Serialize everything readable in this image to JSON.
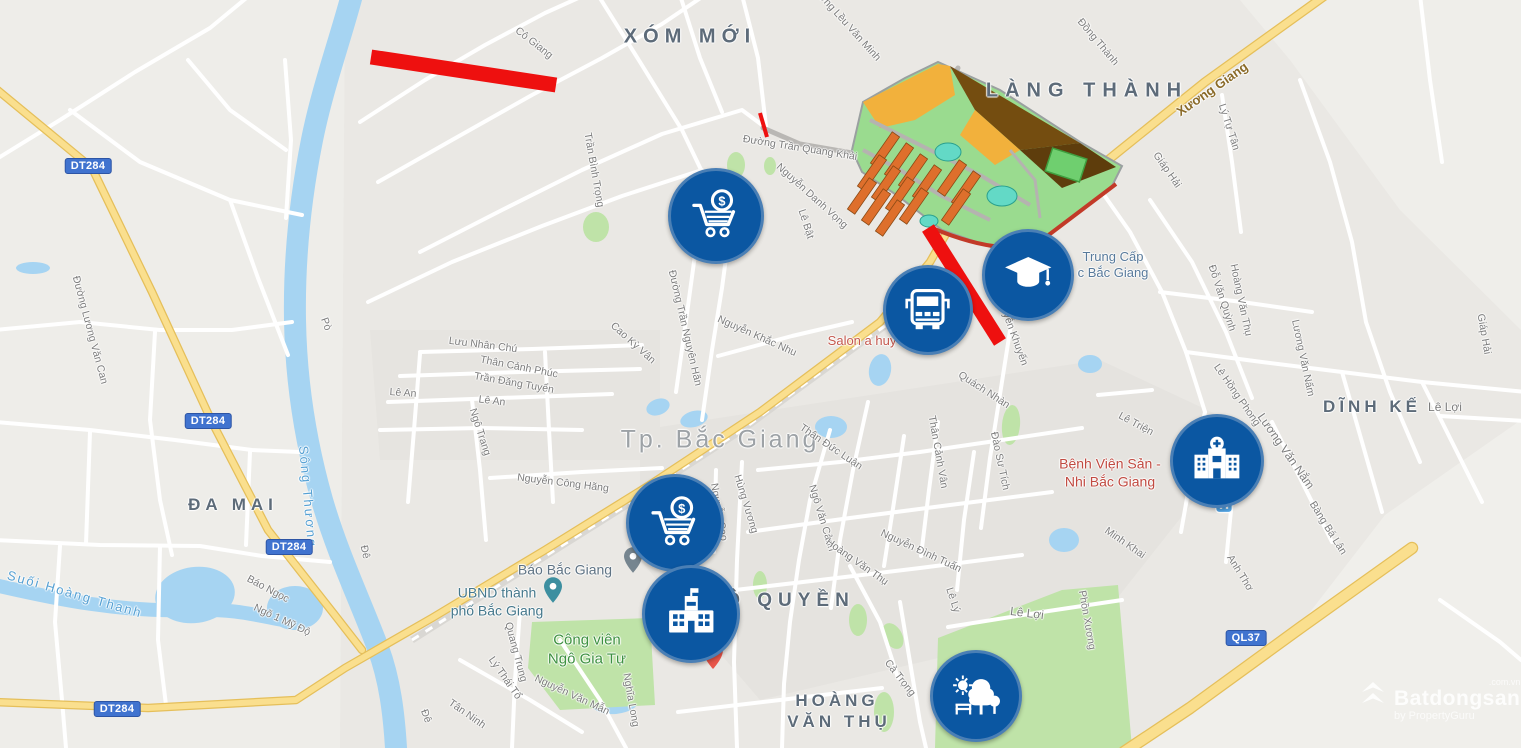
{
  "meta": {
    "width": 1521,
    "height": 748
  },
  "watermark": {
    "brand": "Batdongsan",
    "suffix": ".com.vn",
    "byline": "by PropertyGuru"
  },
  "shields": [
    {
      "t": "DT284",
      "x": 88,
      "y": 166
    },
    {
      "t": "DT284",
      "x": 208,
      "y": 421
    },
    {
      "t": "DT284",
      "x": 289,
      "y": 547
    },
    {
      "t": "DT284",
      "x": 117,
      "y": 709
    },
    {
      "t": "QL37",
      "x": 1246,
      "y": 638
    }
  ],
  "area_labels": [
    {
      "t": "XÓM MỚI",
      "x": 690,
      "y": 37,
      "fs": 20,
      "ls": 6
    },
    {
      "t": "LÀNG THÀNH",
      "x": 1087,
      "y": 91,
      "fs": 20,
      "ls": 7
    },
    {
      "t": "ĐA MAI",
      "x": 233,
      "y": 505,
      "fs": 17,
      "ls": 5
    },
    {
      "t": "DĨNH KẾ",
      "x": 1372,
      "y": 407,
      "fs": 17,
      "ls": 4
    },
    {
      "t": "Ô QUYỀN",
      "x": 790,
      "y": 601,
      "fs": 19,
      "ls": 6
    },
    {
      "t": "HOÀNG",
      "x": 837,
      "y": 701,
      "fs": 17,
      "ls": 4
    },
    {
      "t": "VĂN THỤ",
      "x": 839,
      "y": 722,
      "fs": 17,
      "ls": 4
    }
  ],
  "city_label": {
    "t": "Tp. Bắc Giang",
    "x": 720,
    "y": 440,
    "fs": 25,
    "ls": 3
  },
  "street_labels": [
    {
      "t": "Cô Giang",
      "x": 534,
      "y": 43,
      "r": 38
    },
    {
      "t": "Đường Lều Văn Minh",
      "x": 845,
      "y": 22,
      "r": 48
    },
    {
      "t": "Đồng Thành",
      "x": 1098,
      "y": 42,
      "r": 50
    },
    {
      "t": "Lý Tự Tân",
      "x": 1229,
      "y": 127,
      "r": 72
    },
    {
      "t": "Giáp Hải",
      "x": 1167,
      "y": 170,
      "r": 55
    },
    {
      "t": "Giáp Hải",
      "x": 1484,
      "y": 334,
      "r": 80
    },
    {
      "t": "Trần Bình Trọng",
      "x": 594,
      "y": 170,
      "r": 80
    },
    {
      "t": "Đường Trần Quang Khải",
      "x": 800,
      "y": 148,
      "r": 9
    },
    {
      "t": "Nguyễn Danh Vọng",
      "x": 812,
      "y": 196,
      "r": 42
    },
    {
      "t": "Lê Bật",
      "x": 806,
      "y": 224,
      "r": 72
    },
    {
      "t": "Đường Lương Văn Can",
      "x": 90,
      "y": 330,
      "r": 75
    },
    {
      "t": "Pò",
      "x": 326,
      "y": 324,
      "r": 70
    },
    {
      "t": "Đê",
      "x": 365,
      "y": 552,
      "r": 78
    },
    {
      "t": "Đê",
      "x": 426,
      "y": 716,
      "r": 70
    },
    {
      "t": "Báo Ngọc",
      "x": 268,
      "y": 589,
      "r": 28
    },
    {
      "t": "Ngõ 1 Mỹ Độ",
      "x": 282,
      "y": 620,
      "r": 25
    },
    {
      "t": "Lưu Nhân Chú",
      "x": 483,
      "y": 345,
      "r": 7
    },
    {
      "t": "Thân Cảnh Phúc",
      "x": 519,
      "y": 367,
      "r": 11
    },
    {
      "t": "Trần Đăng Tuyển",
      "x": 514,
      "y": 383,
      "r": 10
    },
    {
      "t": "Lê An",
      "x": 403,
      "y": 393,
      "r": 4
    },
    {
      "t": "Lê An",
      "x": 492,
      "y": 401,
      "r": 7
    },
    {
      "t": "Ngô Trang",
      "x": 480,
      "y": 432,
      "r": 72
    },
    {
      "t": "Cao Kỳ Vân",
      "x": 633,
      "y": 343,
      "r": 42
    },
    {
      "t": "Đường Trần Nguyên Hãn",
      "x": 685,
      "y": 328,
      "r": 77
    },
    {
      "t": "Nguyễn Khắc Nhu",
      "x": 757,
      "y": 336,
      "r": 24
    },
    {
      "t": "Nguyễn Khuyến",
      "x": 1012,
      "y": 330,
      "r": 70
    },
    {
      "t": "Quách Nhàn",
      "x": 984,
      "y": 390,
      "r": 33
    },
    {
      "t": "Đào Sư Tích",
      "x": 1000,
      "y": 461,
      "r": 78
    },
    {
      "t": "Thân Đức Luận",
      "x": 831,
      "y": 447,
      "r": 34
    },
    {
      "t": "Thân Cảnh Vân",
      "x": 938,
      "y": 452,
      "r": 80
    },
    {
      "t": "Hùng Vương",
      "x": 746,
      "y": 504,
      "r": 73
    },
    {
      "t": "Nguyễn Cao",
      "x": 719,
      "y": 512,
      "r": 80
    },
    {
      "t": "Nguyễn Công Hãng",
      "x": 563,
      "y": 483,
      "r": 7
    },
    {
      "t": "Ngô Văn Cảnh",
      "x": 822,
      "y": 518,
      "r": 73
    },
    {
      "t": "Hoàng Văn Thụ",
      "x": 857,
      "y": 562,
      "r": 35
    },
    {
      "t": "Nguyễn Đình Tuấn",
      "x": 921,
      "y": 551,
      "r": 25
    },
    {
      "t": "Lê Triện",
      "x": 1136,
      "y": 424,
      "r": 28
    },
    {
      "t": "Lê Hồng Phong",
      "x": 1237,
      "y": 395,
      "r": 55
    },
    {
      "t": "Đỗ Văn Quỳnh",
      "x": 1222,
      "y": 298,
      "r": 72
    },
    {
      "t": "Hoàng Văn Thụ",
      "x": 1241,
      "y": 300,
      "r": 78
    },
    {
      "t": "Lương Văn Nấm",
      "x": 1303,
      "y": 358,
      "r": 78
    },
    {
      "t": "Lương Văn Nắm",
      "x": 1286,
      "y": 451,
      "r": 55,
      "fs": 12
    },
    {
      "t": "Minh Khai",
      "x": 1125,
      "y": 543,
      "r": 35
    },
    {
      "t": "Bàng Bá Lân",
      "x": 1328,
      "y": 528,
      "r": 58
    },
    {
      "t": "Anh Thơ",
      "x": 1240,
      "y": 573,
      "r": 58
    },
    {
      "t": "Lê Lợi",
      "x": 1445,
      "y": 407,
      "r": 0,
      "fs": 12
    },
    {
      "t": "Lê Lợi",
      "x": 1027,
      "y": 613,
      "r": 7,
      "fs": 12
    },
    {
      "t": "Lê Lý",
      "x": 953,
      "y": 600,
      "r": 72
    },
    {
      "t": "Phồn Xương",
      "x": 1087,
      "y": 620,
      "r": 80
    },
    {
      "t": "Cả Trọng",
      "x": 900,
      "y": 678,
      "r": 52
    },
    {
      "t": "Quang Trung",
      "x": 516,
      "y": 652,
      "r": 75
    },
    {
      "t": "Lý Thái Tổ",
      "x": 505,
      "y": 678,
      "r": 55
    },
    {
      "t": "Tân Ninh",
      "x": 467,
      "y": 714,
      "r": 35
    },
    {
      "t": "Nguyễn Văn Mẫn",
      "x": 572,
      "y": 695,
      "r": 25
    },
    {
      "t": "Nghĩa Long",
      "x": 631,
      "y": 700,
      "r": 80
    }
  ],
  "road_name_labels": [
    {
      "t": "Xương Giang",
      "x": 1212,
      "y": 89,
      "r": -35
    }
  ],
  "water_labels": [
    {
      "t": "Sông Thương",
      "x": 308,
      "y": 497,
      "r": 85
    },
    {
      "t": "Suối Hoàng Thanh",
      "x": 75,
      "y": 594,
      "r": 16
    }
  ],
  "poi_labels": [
    {
      "lines": [
        "Trung Cấp",
        "c Bắc Giang"
      ],
      "x": 1113,
      "y": 265,
      "color": "#587a9b",
      "fs": 13
    },
    {
      "lines": [
        "Bệnh Viện Sản -",
        "Nhi Bắc Giang"
      ],
      "x": 1110,
      "y": 473,
      "color": "#c14a41",
      "fs": 14
    },
    {
      "lines": [
        "Salon a huy"
      ],
      "x": 862,
      "y": 341,
      "color": "#c4584e",
      "fs": 13
    },
    {
      "lines": [
        "Báo Bắc Giang"
      ],
      "x": 565,
      "y": 570,
      "color": "#5f7384",
      "fs": 14
    },
    {
      "lines": [
        "UBND thành",
        "phố Bắc Giang"
      ],
      "x": 497,
      "y": 602,
      "color": "#45788c",
      "fs": 14
    },
    {
      "lines": [
        "Công viên",
        "Ngô Gia Tự"
      ],
      "x": 587,
      "y": 650,
      "color": "#3d9140",
      "fs": 15
    }
  ],
  "markers": [
    {
      "icon": "cart",
      "x": 713,
      "y": 213,
      "d": 90
    },
    {
      "icon": "bus",
      "x": 925,
      "y": 307,
      "d": 84
    },
    {
      "icon": "graduation",
      "x": 1025,
      "y": 272,
      "d": 86
    },
    {
      "icon": "cart",
      "x": 672,
      "y": 520,
      "d": 92
    },
    {
      "icon": "school",
      "x": 688,
      "y": 611,
      "d": 92
    },
    {
      "icon": "hospital",
      "x": 1214,
      "y": 458,
      "d": 88
    },
    {
      "icon": "park",
      "x": 973,
      "y": 693,
      "d": 86
    }
  ],
  "pins": [
    {
      "type": "poi-gray",
      "x": 633,
      "y": 578
    },
    {
      "type": "poi-teal",
      "x": 553,
      "y": 608
    },
    {
      "type": "hospital-red",
      "x": 713,
      "y": 674
    },
    {
      "type": "transit",
      "x": 1224,
      "y": 524
    }
  ],
  "red_segments": [
    {
      "x1": 371,
      "y1": 57,
      "x2": 556,
      "y2": 85,
      "w": 15
    },
    {
      "x1": 928,
      "y1": 228,
      "x2": 1000,
      "y2": 342,
      "w": 14
    },
    {
      "x1": 760,
      "y1": 113,
      "x2": 767,
      "y2": 137,
      "w": 4
    }
  ],
  "geometry": {
    "tints": [
      {
        "d": "M0,0 L345,0 L340,748 L0,748 Z",
        "f": "#eeede9"
      },
      {
        "d": "M1385,515 L1521,420 L1521,748 L1140,748 L1300,625 Z",
        "f": "#f0efeb"
      },
      {
        "d": "M1240,0 L1521,0 L1521,330 L1400,210 L1290,60 Z",
        "f": "#efeeea"
      },
      {
        "d": "M640,430 L1100,360 L1250,430 L1100,620 L760,700 L640,560 Z",
        "f": "#e5e3df"
      },
      {
        "d": "M370,330 L660,330 L660,460 L380,460 Z",
        "f": "#e6e4e0"
      }
    ],
    "water_paths": [
      {
        "d": "M352,-5 C340,40 322,90 312,140 C300,200 294,260 295,320 C296,380 305,440 322,500 C338,555 360,600 378,648 C390,680 394,715 396,748",
        "w": 22
      },
      {
        "d": "M-5,585 C60,600 120,612 190,610 C240,608 265,618 295,622",
        "w": 14
      }
    ],
    "ponds": [
      {
        "x": 33,
        "y": 268,
        "rx": 17,
        "ry": 6,
        "r": 0
      },
      {
        "x": 658,
        "y": 407,
        "rx": 12,
        "ry": 8,
        "r": -20
      },
      {
        "x": 694,
        "y": 419,
        "rx": 14,
        "ry": 8,
        "r": -15
      },
      {
        "x": 831,
        "y": 427,
        "rx": 16,
        "ry": 11,
        "r": 0
      },
      {
        "x": 880,
        "y": 370,
        "rx": 11,
        "ry": 16,
        "r": 10
      },
      {
        "x": 1090,
        "y": 364,
        "rx": 12,
        "ry": 9,
        "r": 0
      },
      {
        "x": 1064,
        "y": 540,
        "rx": 15,
        "ry": 12,
        "r": 0
      },
      {
        "x": 195,
        "y": 595,
        "rx": 40,
        "ry": 28,
        "r": -8
      },
      {
        "x": 295,
        "y": 608,
        "rx": 28,
        "ry": 22,
        "r": 0
      },
      {
        "x": 585,
        "y": 680,
        "rx": 35,
        "ry": 18,
        "r": -10
      },
      {
        "x": 615,
        "y": 700,
        "rx": 25,
        "ry": 14,
        "r": -5
      },
      {
        "x": 1055,
        "y": 700,
        "rx": 52,
        "ry": 42,
        "r": 0
      }
    ],
    "greens": [
      {
        "type": "poly",
        "d": "M532,622 L650,618 L655,705 L560,710 L528,668 Z"
      },
      {
        "type": "poly",
        "d": "M938,638 L1062,590 L1118,585 L1132,748 L935,748 Z"
      },
      {
        "type": "ell",
        "x": 596,
        "y": 227,
        "rx": 13,
        "ry": 15,
        "r": 0
      },
      {
        "type": "ell",
        "x": 736,
        "y": 165,
        "rx": 9,
        "ry": 13,
        "r": 0
      },
      {
        "type": "ell",
        "x": 770,
        "y": 166,
        "rx": 6,
        "ry": 9,
        "r": 0
      },
      {
        "type": "ell",
        "x": 1011,
        "y": 425,
        "rx": 9,
        "ry": 20,
        "r": 5
      },
      {
        "type": "ell",
        "x": 858,
        "y": 620,
        "rx": 9,
        "ry": 16,
        "r": 0
      },
      {
        "type": "ell",
        "x": 884,
        "y": 712,
        "rx": 10,
        "ry": 20,
        "r": 0
      },
      {
        "type": "ell",
        "x": 760,
        "y": 585,
        "rx": 7,
        "ry": 14,
        "r": 0
      },
      {
        "type": "ell",
        "x": 893,
        "y": 636,
        "rx": 9,
        "ry": 14,
        "r": -30
      }
    ],
    "railway": {
      "d": "M412,640 L520,572 L622,508 L742,430 L862,342 L905,312"
    },
    "roads_white": [
      "M-5,160 L60,120 L135,72 L210,28 L250,-5",
      "M70,110 L140,162 L230,200 L302,215",
      "M230,200 L258,278 L288,355",
      "M-5,330 L80,322 L160,330 L232,330 L292,322",
      "M155,332 L150,420 L160,500 L172,555",
      "M-5,422 L90,430 L175,440 L252,450 L300,452",
      "M-5,540 L100,545 L200,546 L262,556 L330,562",
      "M60,546 L55,622 L62,700 L66,748",
      "M160,546 L158,640 L166,705",
      "M250,452 L246,545",
      "M90,432 L86,544",
      "M285,60 L291,140 L286,218",
      "M188,60 L230,110 L286,150",
      "M360,122 L425,80 L485,45 L545,13 L585,-5",
      "M378,182 L452,140 L532,95 L602,58 L662,24 L705,-5",
      "M598,-5 L640,62 L682,130 L705,178",
      "M420,252 L502,210 L582,170 L662,134 L742,110 L766,128",
      "M368,302 L452,262 L542,226 L622,196 L702,170",
      "M680,-5 L700,58 L722,112",
      "M742,-5 L758,58 L766,126",
      "M420,352 L532,349 L642,345",
      "M400,376 L520,372 L640,369",
      "M388,402 L500,398 L612,394",
      "M380,430 L482,428 L582,430",
      "M472,400 L480,470 L486,540",
      "M420,354 L414,430 L408,502",
      "M545,352 L549,430 L553,502",
      "M676,392 L685,328 L694,262 L703,196",
      "M702,420 L712,350 L722,288 L730,228",
      "M718,356 L792,336 L852,322",
      "M490,478 L582,472 L662,468",
      "M742,462 L737,560 L734,662 L737,748",
      "M716,470 L714,552",
      "M830,430 L810,500 L799,560 L790,622 L784,684 L782,748",
      "M868,402 L853,470 L840,540 L831,608",
      "M904,436 L894,502 L884,566",
      "M938,422 L929,490 L921,556",
      "M974,452 L964,520 L957,590",
      "M1012,318 L1001,388 L990,458 L981,528",
      "M758,470 L840,462 L920,452 L1002,440 L1082,428",
      "M748,532 L850,518 L950,505 L1052,492",
      "M718,592 L820,580 L920,568 L1022,555",
      "M948,627 L1042,612 L1122,600",
      "M678,712 L780,700 L882,688",
      "M1090,175 L1130,232 L1162,292 L1186,352 L1205,412",
      "M1150,200 L1192,262 L1226,332 L1252,398",
      "M1222,95 L1232,162 L1241,232",
      "M1300,80 L1330,162 L1352,242 L1366,322",
      "M1420,-5 L1430,80 L1442,162",
      "M1366,322 L1390,392 L1420,462",
      "M1160,292 L1242,302 L1312,312",
      "M1186,352 L1262,362 L1342,372 L1422,382 L1526,392",
      "M1205,412 L1192,470 L1181,532",
      "M1242,432 L1232,500 L1226,562",
      "M1272,422 L1302,482 L1332,542",
      "M1342,372 L1362,442 L1382,512",
      "M1422,382 L1452,442 L1482,502",
      "M1440,416 L1526,421",
      "M900,602 L910,662 L920,722 L926,748",
      "M850,566 L880,622 L898,678",
      "M520,610 L515,680 L512,748",
      "M460,660 L530,700 L582,732",
      "M560,640 L600,700 L626,748",
      "M1440,600 L1500,642 L1521,660",
      "M1098,395 L1152,390"
    ],
    "roads_gray": [
      "M763,128 L800,144 L852,153 L898,150",
      "M898,150 L938,98 L958,68"
    ],
    "roads_yellow": [
      {
        "d": "M-5,88 L92,168 L152,292 L212,422 L268,530 L334,614 L362,650",
        "w": 6
      },
      {
        "d": "M-5,702 L148,708 L296,700 L345,668 L432,618 L545,550 L648,486 L760,412 L880,322 L930,262 L946,234",
        "w": 6
      },
      {
        "d": "M1330,-8 L1205,82 L1118,152 L1086,178",
        "w": 7
      },
      {
        "d": "M1412,548 L1300,628 L1190,708 L1124,752",
        "w": 10
      }
    ],
    "plan": {
      "outer": "M852,150 L863,102 L905,78 L938,62 L1000,90 L1080,142 L1122,166 L1112,186 L1038,243 L1005,252 L942,230 L898,196 L862,172 Z",
      "zones": [
        {
          "d": "M950,66 L1080,143 L1020,150 L975,110 Z",
          "f": "#744d10"
        },
        {
          "d": "M1020,150 L1080,143 L1116,167 L1062,188 Z",
          "f": "#5e3d0c"
        },
        {
          "d": "M863,102 L938,64 L950,66 L955,95 L915,120 L880,128 Z",
          "f": "#f2b13c"
        },
        {
          "d": "M975,110 L1020,150 L995,165 L960,135 Z",
          "f": "#f2b13c"
        }
      ],
      "bars": [
        {
          "x": 885,
          "y": 150
        },
        {
          "x": 899,
          "y": 161
        },
        {
          "x": 913,
          "y": 172
        },
        {
          "x": 927,
          "y": 183
        },
        {
          "x": 872,
          "y": 173
        },
        {
          "x": 886,
          "y": 184
        },
        {
          "x": 900,
          "y": 195
        },
        {
          "x": 914,
          "y": 206
        },
        {
          "x": 862,
          "y": 196
        },
        {
          "x": 876,
          "y": 207
        },
        {
          "x": 890,
          "y": 218
        },
        {
          "x": 952,
          "y": 178
        },
        {
          "x": 966,
          "y": 189
        },
        {
          "x": 956,
          "y": 207
        }
      ],
      "ponds": [
        {
          "x": 948,
          "y": 152,
          "rx": 13,
          "ry": 9
        },
        {
          "x": 1002,
          "y": 196,
          "rx": 15,
          "ry": 10
        },
        {
          "x": 929,
          "y": 221,
          "rx": 9,
          "ry": 6
        }
      ],
      "lines": [
        {
          "d": "M870,120 L930,150 L980,175 L1030,205",
          "c": "#b5b3b0",
          "w": 4
        },
        {
          "d": "M863,150 L900,170 L940,195 L990,220",
          "c": "#b5b3b0",
          "w": 4
        },
        {
          "d": "M1010,150 L1035,180 L1040,218",
          "c": "#b5b3b0",
          "w": 3
        },
        {
          "d": "M932,228 C990,252 1020,250 1042,240 L1116,184",
          "c": "#c23a28",
          "w": 4
        }
      ],
      "field": {
        "x": 1048,
        "y": 153,
        "w": 36,
        "h": 24,
        "r": 18
      }
    }
  },
  "colors": {
    "marker_blue": "#0b57a2",
    "marker_ring": "#4a7fb5",
    "red_overlay": "#ee100f",
    "water": "#a6d4f2",
    "park_green": "#bfe3a8",
    "road_yellow": "#fadf8e",
    "shield_blue": "#4073cf",
    "plan_orange": "#de6f2c",
    "plan_amber": "#f2b13c"
  }
}
